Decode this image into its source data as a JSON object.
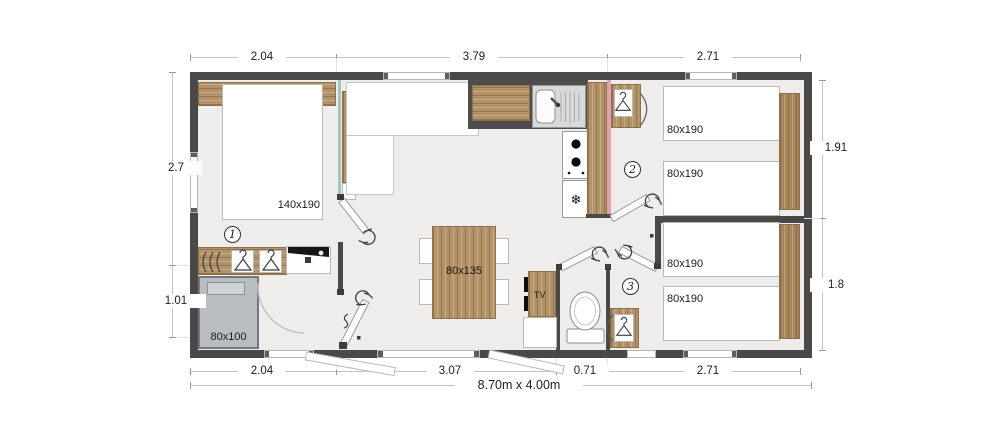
{
  "plan": {
    "total_label": "8.70m x 4.00m",
    "dims_top": [
      "2.04",
      "3.79",
      "2.71"
    ],
    "dims_bottom": [
      "2.04",
      "3.07",
      "0.71",
      "2.71"
    ],
    "dims_left": [
      "2.7",
      "1.01"
    ],
    "dims_right": [
      "1.91",
      "1.8"
    ],
    "rooms": {
      "bedroom_master": {
        "badge": "1",
        "bed": "140x190",
        "shower": "80x100"
      },
      "bedroom_2": {
        "badge": "2",
        "beds": [
          "80x190",
          "80x190"
        ]
      },
      "bedroom_3": {
        "badge": "3",
        "beds": [
          "80x190",
          "80x190"
        ]
      },
      "living": {
        "table": "80x135",
        "tv": "TV"
      }
    },
    "icons": {
      "snowflake": "❄"
    },
    "colors": {
      "wall": "#4a4947",
      "floor": "#eeedeb",
      "wood": "#b3946a",
      "glass_partition": "#9ec9bd",
      "kitchen_wall_accent": "#e2a2b2",
      "shower": "#b8bdc1"
    }
  }
}
